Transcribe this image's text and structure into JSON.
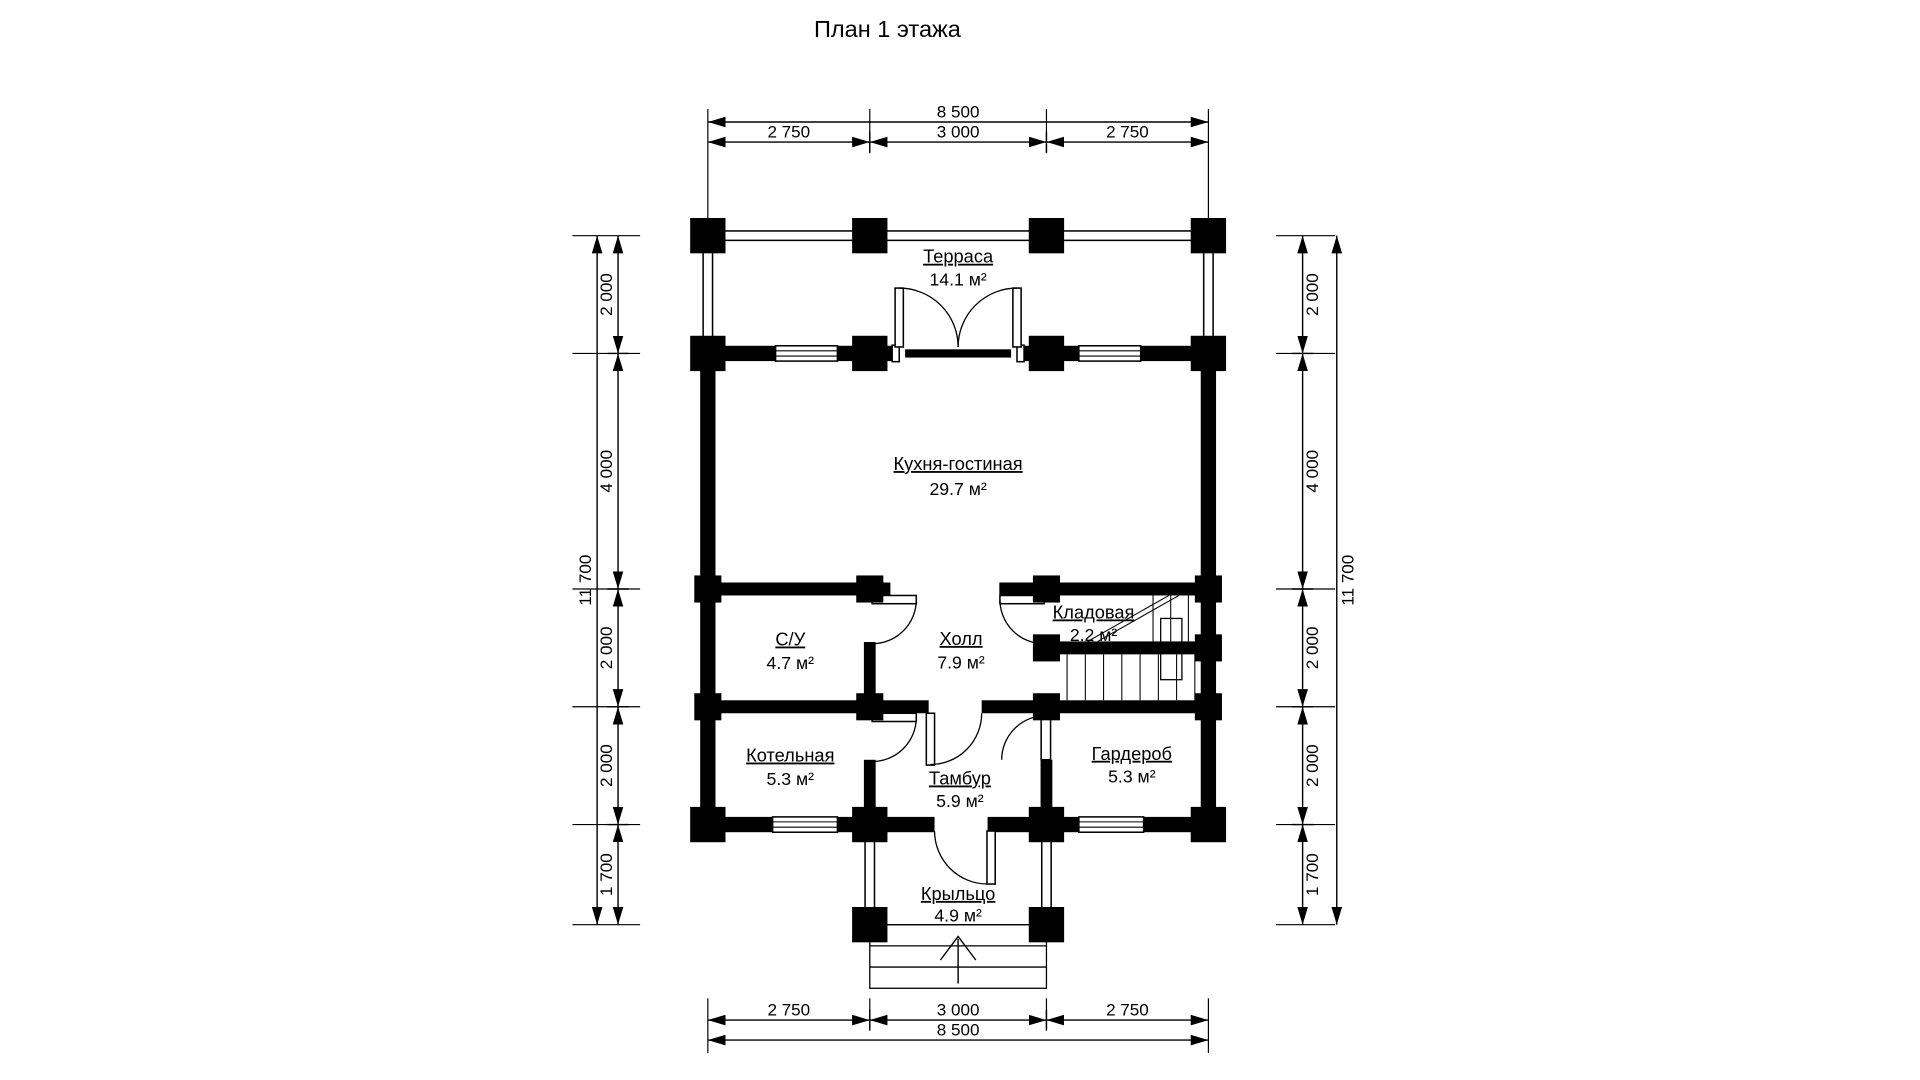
{
  "title": "План 1 этажа",
  "rooms": {
    "terrace": {
      "name": "Терраса",
      "area": "14.1 м²"
    },
    "kitchen": {
      "name": "Кухня-гостиная",
      "area": "29.7 м²"
    },
    "wc": {
      "name": "С/У",
      "area": "4.7 м²"
    },
    "hall": {
      "name": "Холл",
      "area": "7.9 м²"
    },
    "storage": {
      "name": "Кладовая",
      "area": "2.2 м²"
    },
    "boiler": {
      "name": "Котельная",
      "area": "5.3 м²"
    },
    "vestibule": {
      "name": "Тамбур",
      "area": "5.9 м²"
    },
    "wardrobe": {
      "name": "Гардероб",
      "area": "5.3 м²"
    },
    "porch": {
      "name": "Крыльцо",
      "area": "4.9 м²"
    }
  },
  "dimensions": {
    "top": {
      "overall": "8 500",
      "segments": [
        "2 750",
        "3 000",
        "2 750"
      ]
    },
    "bottom": {
      "overall": "8 500",
      "segments": [
        "2 750",
        "3 000",
        "2 750"
      ]
    },
    "left": {
      "overall": "11 700",
      "segments": [
        "2 000",
        "4 000",
        "2 000",
        "2 000",
        "1 700"
      ]
    },
    "right": {
      "overall": "11 700",
      "segments": [
        "2 000",
        "4 000",
        "2 000",
        "2 000",
        "1 700"
      ]
    }
  },
  "colors": {
    "ink": "#000000",
    "paper": "#ffffff"
  }
}
